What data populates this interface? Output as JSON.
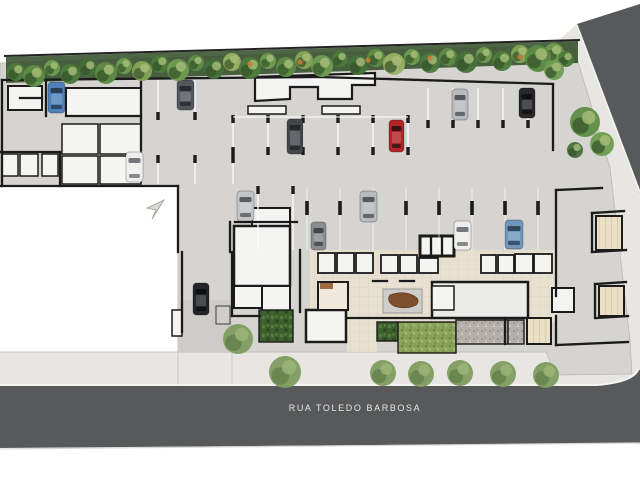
{
  "plan": {
    "title": "Ground floor / parking site plan",
    "street_label": "RUA TOLEDO BARBOSA",
    "palette": {
      "bg": "#ffffff",
      "sidewalk": "#e7e6e3",
      "sidewalk_edge": "#c9c8c5",
      "street": "#58595b",
      "curb": "#f7f7f5",
      "concrete": "#d5d4d0",
      "driveway": "#cdccc8",
      "wall": "#1b1b1b",
      "room_white": "#f4f4f2",
      "room_gray": "#ebebe9",
      "beige": "#e8e1d2",
      "beige_line": "#ddd5c3",
      "tatami": "#eadfc4",
      "tatami_line": "#d8cdb0",
      "wood": "#9c6b43",
      "wood_dark": "#7d4f2c",
      "pad": "#cfcecb",
      "stall": "#ffffff",
      "lawn": "#8aa35a",
      "lawn_dot1": "#6d8a45",
      "lawn_dot2": "#a3bb74",
      "shrub": "#3d602f",
      "shrub_dot1": "#567d3c",
      "shrub_dot2": "#2c4a22",
      "gravel": "#b5afac",
      "gravel_dot1": "#948e8a",
      "gravel_dot2": "#cfcac6",
      "band_base": "#2f4a26",
      "tree_greens": [
        "#4d7a3c",
        "#5e8c46",
        "#6f9c50",
        "#46703a",
        "#86a757",
        "#9ab065"
      ],
      "tree_accent": "#c77a3a",
      "tree_walk": "#7f9c60",
      "tree_walk_dark": "#5e7a48",
      "tree_walk_light": "#9cb579",
      "arrow": "#d8d8d4"
    },
    "sidewalks": [
      {
        "points": "0,352 640,352 640,392 0,392"
      },
      {
        "points": "552,46 578,23 640,190 640,392 552,392"
      }
    ],
    "streets": {
      "side_triangle": "577,24 640,4 640,193",
      "bottom_path": "M0,386 L597,386 Q634,383 639,370 L640,370 L640,443 L0,448 Z",
      "bottom_curb": "M0,385 L597,385 Q633,382 638,369",
      "side_curb": "M577,25 L640,192",
      "under_line": "M0,449 L640,443"
    },
    "site_polygon": "0,63 573,45 610,168 630,340 632,374 556,375 546,352 178,352 178,186 0,186",
    "white_lot": {
      "x": 0,
      "y": 187,
      "w": 177,
      "h": 164
    },
    "driveway": {
      "x": 178,
      "y": 300,
      "w": 54,
      "h": 52
    },
    "curb_cuts": [
      [
        178,
        352,
        178,
        386
      ],
      [
        232,
        352,
        232,
        386
      ]
    ],
    "tree_band": {
      "base": "6,57 578,41 578,63 6,83",
      "boundary": [
        4,
        56,
        580,
        40
      ],
      "trees": [
        [
          16,
          72,
          9,
          0
        ],
        [
          34,
          76,
          11,
          1
        ],
        [
          52,
          68,
          8,
          2
        ],
        [
          70,
          74,
          10,
          0
        ],
        [
          88,
          68,
          9,
          3
        ],
        [
          106,
          73,
          11,
          1
        ],
        [
          124,
          66,
          8,
          2
        ],
        [
          142,
          71,
          10,
          4
        ],
        [
          160,
          64,
          9,
          0
        ],
        [
          178,
          70,
          11,
          2
        ],
        [
          196,
          63,
          8,
          1
        ],
        [
          214,
          69,
          10,
          3
        ],
        [
          232,
          62,
          9,
          5
        ],
        [
          250,
          68,
          11,
          0
        ],
        [
          268,
          61,
          8,
          2
        ],
        [
          286,
          67,
          10,
          1
        ],
        [
          304,
          60,
          9,
          4
        ],
        [
          322,
          66,
          11,
          2
        ],
        [
          340,
          59,
          8,
          0
        ],
        [
          358,
          65,
          10,
          3
        ],
        [
          376,
          58,
          9,
          1
        ],
        [
          394,
          64,
          11,
          5
        ],
        [
          412,
          57,
          8,
          2
        ],
        [
          430,
          63,
          10,
          0
        ],
        [
          448,
          57,
          9,
          1
        ],
        [
          466,
          62,
          11,
          3
        ],
        [
          484,
          55,
          8,
          2
        ],
        [
          502,
          61,
          10,
          0
        ],
        [
          520,
          54,
          9,
          4
        ],
        [
          538,
          60,
          12,
          1
        ],
        [
          554,
          53,
          10,
          2
        ],
        [
          566,
          59,
          8,
          0
        ]
      ],
      "accents": [
        [
          300,
          62
        ],
        [
          368,
          60
        ],
        [
          430,
          58
        ],
        [
          520,
          57
        ],
        [
          250,
          64
        ]
      ]
    },
    "right_trees": [
      [
        538,
        58,
        13,
        1
      ],
      [
        554,
        70,
        10,
        2
      ],
      [
        585,
        122,
        15,
        1
      ],
      [
        602,
        144,
        12,
        2
      ],
      [
        575,
        150,
        8,
        3
      ]
    ],
    "walk_trees": [
      {
        "x": 285,
        "y": 372,
        "r": 16
      },
      {
        "x": 238,
        "y": 339,
        "r": 15
      },
      {
        "x": 383,
        "y": 373,
        "r": 13
      },
      {
        "x": 421,
        "y": 374,
        "r": 13
      },
      {
        "x": 460,
        "y": 373,
        "r": 13
      },
      {
        "x": 503,
        "y": 374,
        "r": 13
      },
      {
        "x": 546,
        "y": 375,
        "r": 13
      }
    ],
    "beige_floors": [
      {
        "x": 310,
        "y": 250,
        "w": 246,
        "h": 72
      },
      {
        "x": 347,
        "y": 312,
        "w": 30,
        "h": 40
      },
      {
        "x": 310,
        "y": 310,
        "w": 37,
        "h": 34
      }
    ],
    "maze_room_path": "M255,101 L255,77 L375,73 L375,85 L352,85 L352,99 L318,99 L318,87 L290,87 L290,99 L255,101 Z",
    "rooms": [
      {
        "x": 8,
        "y": 86,
        "w": 34,
        "h": 24,
        "fill": "white",
        "bw": 2
      },
      {
        "x": 66,
        "y": 88,
        "w": 75,
        "h": 28,
        "fill": "white",
        "bw": 2
      },
      {
        "x": 2,
        "y": 154,
        "w": 16,
        "h": 22,
        "fill": "white",
        "bw": 1.5
      },
      {
        "x": 20,
        "y": 154,
        "w": 18,
        "h": 22,
        "fill": "white",
        "bw": 1.5
      },
      {
        "x": 42,
        "y": 154,
        "w": 16,
        "h": 22,
        "fill": "white",
        "bw": 1.5
      },
      {
        "x": 62,
        "y": 124,
        "w": 36,
        "h": 30,
        "fill": "white",
        "bw": 1.5
      },
      {
        "x": 100,
        "y": 124,
        "w": 41,
        "h": 30,
        "fill": "white",
        "bw": 1.5
      },
      {
        "x": 62,
        "y": 156,
        "w": 36,
        "h": 28,
        "fill": "white",
        "bw": 1.5
      },
      {
        "x": 100,
        "y": 156,
        "w": 41,
        "h": 28,
        "fill": "white",
        "bw": 1.5
      },
      {
        "x": 248,
        "y": 106,
        "w": 38,
        "h": 8,
        "fill": "white",
        "bw": 1.5
      },
      {
        "x": 322,
        "y": 106,
        "w": 38,
        "h": 8,
        "fill": "white",
        "bw": 1.5
      },
      {
        "x": 252,
        "y": 208,
        "w": 38,
        "h": 20,
        "fill": "white",
        "bw": 2
      },
      {
        "x": 234,
        "y": 226,
        "w": 56,
        "h": 60,
        "fill": "white",
        "bw": 2.5
      },
      {
        "x": 234,
        "y": 286,
        "w": 28,
        "h": 22,
        "fill": "white",
        "bw": 2
      },
      {
        "x": 262,
        "y": 286,
        "w": 28,
        "h": 36,
        "fill": "white",
        "bw": 2
      },
      {
        "x": 306,
        "y": 310,
        "w": 40,
        "h": 32,
        "fill": "white",
        "bw": 2.5
      },
      {
        "x": 420,
        "y": 236,
        "w": 34,
        "h": 20,
        "fill": "white",
        "bw": 3
      },
      {
        "x": 318,
        "y": 253,
        "w": 17,
        "h": 20,
        "fill": "white",
        "bw": 1.8
      },
      {
        "x": 337,
        "y": 253,
        "w": 17,
        "h": 20,
        "fill": "white",
        "bw": 1.8
      },
      {
        "x": 356,
        "y": 253,
        "w": 17,
        "h": 20,
        "fill": "white",
        "bw": 1.8
      },
      {
        "x": 381,
        "y": 255,
        "w": 17,
        "h": 18,
        "fill": "white",
        "bw": 1.8
      },
      {
        "x": 400,
        "y": 255,
        "w": 17,
        "h": 18,
        "fill": "white",
        "bw": 1.8
      },
      {
        "x": 419,
        "y": 258,
        "w": 19,
        "h": 15,
        "fill": "white",
        "bw": 1.8
      },
      {
        "x": 481,
        "y": 255,
        "w": 15,
        "h": 18,
        "fill": "white",
        "bw": 1.8
      },
      {
        "x": 498,
        "y": 255,
        "w": 16,
        "h": 18,
        "fill": "white",
        "bw": 1.8
      },
      {
        "x": 515,
        "y": 254,
        "w": 18,
        "h": 19,
        "fill": "white",
        "bw": 1.8
      },
      {
        "x": 534,
        "y": 254,
        "w": 18,
        "h": 19,
        "fill": "white",
        "bw": 1.8
      },
      {
        "x": 432,
        "y": 282,
        "w": 96,
        "h": 36,
        "fill": "gray",
        "bw": 2.5
      },
      {
        "x": 432,
        "y": 286,
        "w": 22,
        "h": 24,
        "fill": "white",
        "bw": 1.5
      },
      {
        "x": 318,
        "y": 282,
        "w": 30,
        "h": 28,
        "fill": "vest",
        "bw": 2
      },
      {
        "x": 596,
        "y": 216,
        "w": 26,
        "h": 34,
        "fill": "tatami",
        "bw": 2
      },
      {
        "x": 599,
        "y": 286,
        "w": 25,
        "h": 30,
        "fill": "tatami",
        "bw": 2
      },
      {
        "x": 552,
        "y": 288,
        "w": 22,
        "h": 24,
        "fill": "white",
        "bw": 2
      },
      {
        "x": 527,
        "y": 318,
        "w": 24,
        "h": 26,
        "fill": "tatami",
        "bw": 2
      },
      {
        "x": 172,
        "y": 310,
        "w": 10,
        "h": 26,
        "fill": "white",
        "bw": 1.5
      },
      {
        "x": 216,
        "y": 306,
        "w": 14,
        "h": 18,
        "fill": "pad",
        "bw": 0.8
      }
    ],
    "wood_mat": {
      "x": 320,
      "y": 283,
      "w": 13,
      "h": 6
    },
    "reception": {
      "pad": {
        "x": 383,
        "y": 289,
        "w": 39,
        "h": 24
      },
      "desk_path": "M390,295 q14,-5 24,1 q7,4 2,9 q-10,5 -22,1 q-8,-5 -4,-11 z"
    },
    "walls": [
      [
        2,
        80,
        320,
        77
      ],
      [
        320,
        77,
        553,
        84
      ],
      [
        2,
        80,
        2,
        186
      ],
      [
        141,
        78,
        141,
        150
      ],
      [
        46,
        80,
        46,
        116
      ],
      [
        20,
        98,
        42,
        98
      ],
      [
        66,
        116,
        141,
        116
      ],
      [
        0,
        152,
        60,
        152
      ],
      [
        60,
        152,
        60,
        186
      ],
      [
        0,
        186,
        178,
        186
      ],
      [
        178,
        186,
        178,
        252
      ],
      [
        182,
        252,
        182,
        332
      ],
      [
        553,
        84,
        553,
        150
      ],
      [
        556,
        190,
        556,
        296
      ],
      [
        556,
        316,
        556,
        345
      ],
      [
        556,
        190,
        602,
        188
      ],
      [
        556,
        345,
        628,
        342
      ],
      [
        592,
        213,
        624,
        211
      ],
      [
        592,
        213,
        592,
        252
      ],
      [
        592,
        252,
        626,
        250
      ],
      [
        595,
        284,
        626,
        282
      ],
      [
        595,
        284,
        595,
        318
      ],
      [
        596,
        318,
        628,
        316
      ],
      [
        235,
        222,
        297,
        222
      ],
      [
        230,
        222,
        230,
        252
      ],
      [
        232,
        252,
        232,
        316
      ],
      [
        232,
        316,
        260,
        316
      ],
      [
        300,
        250,
        300,
        312
      ],
      [
        348,
        318,
        430,
        318
      ],
      [
        373,
        281,
        387,
        281
      ],
      [
        400,
        281,
        414,
        281
      ],
      [
        505,
        318,
        505,
        344
      ],
      [
        431,
        236,
        431,
        256
      ],
      [
        442,
        236,
        442,
        256
      ]
    ],
    "stall_groups": [
      {
        "lines": [
          158,
          195
        ],
        "y1": 80,
        "y2": 112,
        "ticks_bottom": 112
      },
      {
        "lines": [
          233,
          268,
          303,
          338,
          373,
          408
        ],
        "y1": 117,
        "y2": 155,
        "ticks_top": 115,
        "ticks_bottom": 147
      },
      {
        "lines": [
          428,
          453,
          478,
          503,
          528
        ],
        "y1": 88,
        "y2": 128,
        "ticks_bottom": 120
      },
      {
        "lines": [
          158,
          195,
          233
        ],
        "y1": 157,
        "y2": 184,
        "ticks_top": 155
      },
      {
        "lines": [
          258,
          293
        ],
        "y1": 188,
        "y2": 250,
        "ticks_top": 186
      },
      {
        "lines": [
          307,
          340,
          373,
          406,
          439,
          472,
          505,
          538
        ],
        "y1": 188,
        "y2": 250,
        "faint": true
      }
    ],
    "stall_toplines": [
      [
        233,
        117,
        408,
        117
      ]
    ],
    "columns": [
      [
        307,
        201
      ],
      [
        340,
        201
      ],
      [
        373,
        201
      ],
      [
        406,
        201
      ],
      [
        439,
        201
      ],
      [
        472,
        201
      ],
      [
        505,
        201
      ],
      [
        538,
        201
      ]
    ],
    "gardens": [
      {
        "x": 377,
        "y": 322,
        "w": 21,
        "h": 19,
        "type": "shrub"
      },
      {
        "x": 398,
        "y": 322,
        "w": 58,
        "h": 31,
        "type": "lawn"
      },
      {
        "x": 456,
        "y": 320,
        "w": 52,
        "h": 24,
        "type": "gravel"
      },
      {
        "x": 508,
        "y": 320,
        "w": 16,
        "h": 24,
        "type": "gravel"
      },
      {
        "x": 259,
        "y": 310,
        "w": 34,
        "h": 32,
        "type": "shrub"
      }
    ],
    "cars": [
      {
        "x": 48,
        "y": 82,
        "w": 17,
        "h": 31,
        "body": "#4f80b8",
        "glass": "#2c3e55",
        "name": "blue-car"
      },
      {
        "x": 177,
        "y": 80,
        "w": 17,
        "h": 30,
        "body": "#53565c",
        "glass": "#2a2c30",
        "name": "gray-car"
      },
      {
        "x": 287,
        "y": 119,
        "w": 16,
        "h": 35,
        "body": "#43464b",
        "glass": "#26282c",
        "name": "dark-gray-car"
      },
      {
        "x": 389,
        "y": 120,
        "w": 15,
        "h": 32,
        "body": "#b02427",
        "glass": "#3a1214",
        "name": "red-car"
      },
      {
        "x": 452,
        "y": 89,
        "w": 16,
        "h": 31,
        "body": "#b7bbbf",
        "glass": "#55595e",
        "name": "silver-car"
      },
      {
        "x": 519,
        "y": 88,
        "w": 16,
        "h": 30,
        "body": "#26282b",
        "glass": "#101113",
        "name": "black-car"
      },
      {
        "x": 126,
        "y": 152,
        "w": 17,
        "h": 30,
        "body": "#efefed",
        "glass": "#73787d",
        "name": "white-car"
      },
      {
        "x": 237,
        "y": 191,
        "w": 17,
        "h": 30,
        "body": "#c3c6c9",
        "glass": "#5a5e63",
        "name": "silver-car"
      },
      {
        "x": 311,
        "y": 222,
        "w": 15,
        "h": 28,
        "body": "#8a8d90",
        "glass": "#44474a",
        "name": "gray-minivan"
      },
      {
        "x": 360,
        "y": 191,
        "w": 17,
        "h": 31,
        "body": "#b7bbbf",
        "glass": "#55595e",
        "name": "silver-car"
      },
      {
        "x": 454,
        "y": 221,
        "w": 17,
        "h": 29,
        "body": "#ededeb",
        "glass": "#73787d",
        "name": "white-car"
      },
      {
        "x": 505,
        "y": 220,
        "w": 18,
        "h": 29,
        "body": "#7096bd",
        "glass": "#33475c",
        "name": "blue-car"
      },
      {
        "x": 193,
        "y": 283,
        "w": 16,
        "h": 32,
        "body": "#232527",
        "glass": "#0e0f10",
        "name": "black-car"
      }
    ],
    "north_arrow": "M164,200 L147,208 L156,210 L152,219 Z",
    "tatami_insets": [
      {
        "x": 596,
        "y": 216,
        "w": 26,
        "h": 34
      },
      {
        "x": 599,
        "y": 286,
        "w": 25,
        "h": 30
      },
      {
        "x": 527,
        "y": 318,
        "w": 24,
        "h": 26
      }
    ]
  }
}
